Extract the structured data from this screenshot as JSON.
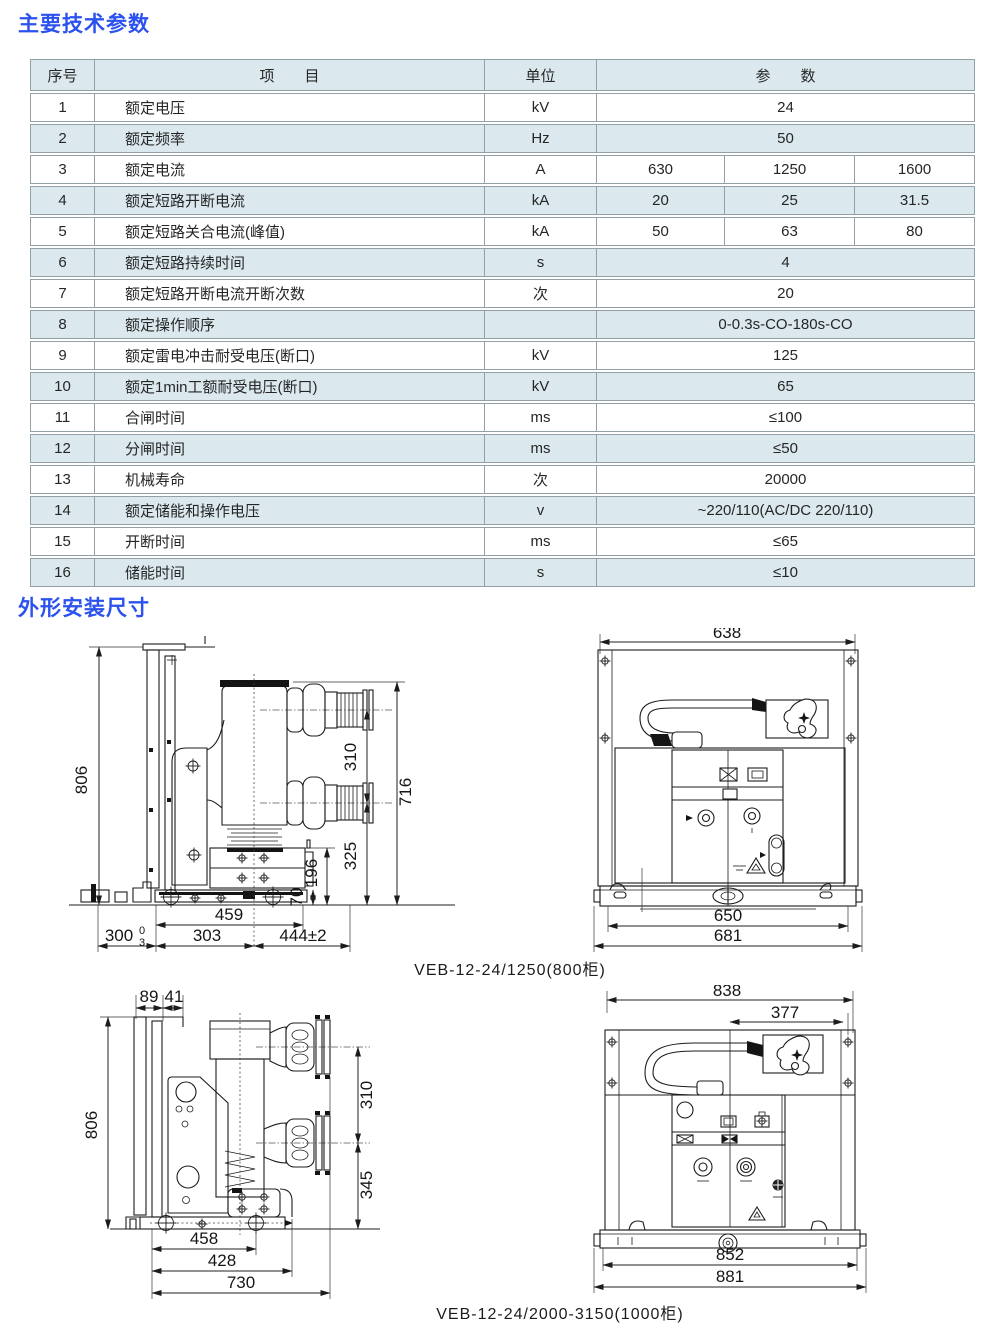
{
  "section1": {
    "title": "主要技术参数"
  },
  "section2": {
    "title": "外形安装尺寸"
  },
  "table": {
    "headers": {
      "no": "序号",
      "item": "项　　目",
      "unit": "单位",
      "param": "参　　数"
    },
    "rows": [
      {
        "no": "1",
        "item": "额定电压",
        "unit": "kV",
        "values": [
          "24"
        ]
      },
      {
        "no": "2",
        "item": "额定频率",
        "unit": "Hz",
        "values": [
          "50"
        ]
      },
      {
        "no": "3",
        "item": "额定电流",
        "unit": "A",
        "values": [
          "630",
          "1250",
          "1600"
        ]
      },
      {
        "no": "4",
        "item": "额定短路开断电流",
        "unit": "kA",
        "values": [
          "20",
          "25",
          "31.5"
        ]
      },
      {
        "no": "5",
        "item": "额定短路关合电流(峰值)",
        "unit": "kA",
        "values": [
          "50",
          "63",
          "80"
        ]
      },
      {
        "no": "6",
        "item": "额定短路持续时间",
        "unit": "s",
        "values": [
          "4"
        ]
      },
      {
        "no": "7",
        "item": "额定短路开断电流开断次数",
        "unit": "次",
        "values": [
          "20"
        ]
      },
      {
        "no": "8",
        "item": "额定操作顺序",
        "unit": "",
        "values": [
          "0-0.3s-CO-180s-CO"
        ]
      },
      {
        "no": "9",
        "item": "额定雷电冲击耐受电压(断口)",
        "unit": "kV",
        "values": [
          "125"
        ]
      },
      {
        "no": "10",
        "item": "额定1min工额耐受电压(断口)",
        "unit": "kV",
        "values": [
          "65"
        ]
      },
      {
        "no": "11",
        "item": "合闸时间",
        "unit": "ms",
        "values": [
          "≤100"
        ]
      },
      {
        "no": "12",
        "item": "分闸时间",
        "unit": "ms",
        "values": [
          "≤50"
        ]
      },
      {
        "no": "13",
        "item": "机械寿命",
        "unit": "次",
        "values": [
          "20000"
        ]
      },
      {
        "no": "14",
        "item": "额定储能和操作电压",
        "unit": "v",
        "values": [
          "~220/110(AC/DC 220/110)"
        ]
      },
      {
        "no": "15",
        "item": "开断时间",
        "unit": "ms",
        "values": [
          "≤65"
        ]
      },
      {
        "no": "16",
        "item": "储能时间",
        "unit": "s",
        "values": [
          "≤10"
        ]
      }
    ]
  },
  "figure1": {
    "caption": "VEB-12-24/1250(800柜)",
    "side": {
      "overall_height": "806",
      "pole_spacing": "310",
      "breaker_height": "716",
      "lower_height": "325",
      "frame_height": "196",
      "base_height": "70",
      "top_width": "459",
      "left_width": "300",
      "left_tol_upper": "0",
      "left_tol_lower": "3",
      "mid_width": "303",
      "right_width": "444±2"
    },
    "front": {
      "top_width": "638",
      "inner_width": "650",
      "outer_width": "681"
    }
  },
  "figure2": {
    "caption": "VEB-12-24/2000-3150(1000柜)",
    "side": {
      "offset_a": "89",
      "offset_b": "41",
      "overall_height": "806",
      "pole_spacing": "310",
      "lower_height": "345",
      "top_width": "458",
      "mid_width": "428",
      "bottom_width": "730"
    },
    "front": {
      "top_width": "838",
      "offset_width": "377",
      "inner_width": "852",
      "outer_width": "881"
    }
  }
}
